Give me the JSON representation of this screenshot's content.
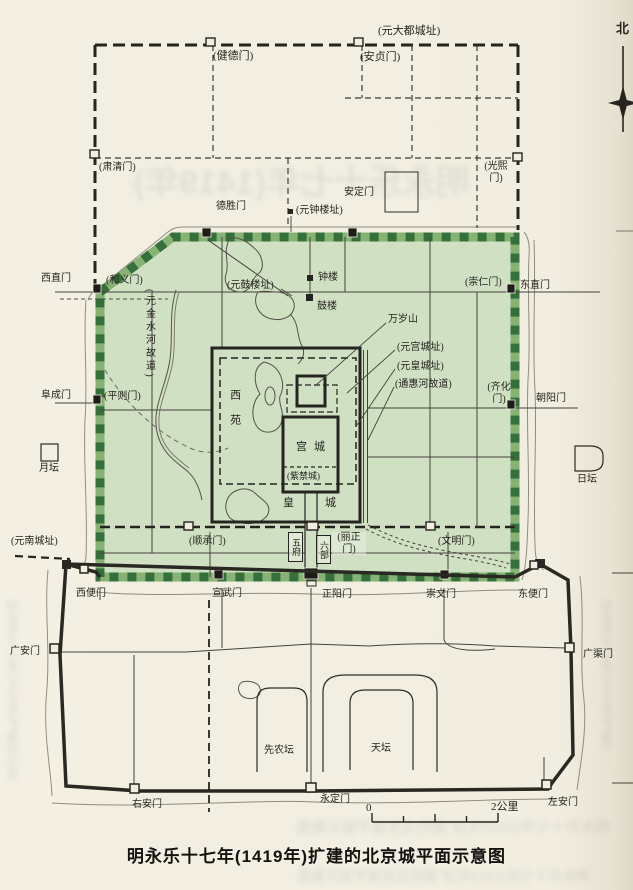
{
  "title": "明永乐十七年(1419年)扩建的北京城平面示意图",
  "compass": {
    "north": "北"
  },
  "scale_bar": {
    "zero": "0",
    "two_km": "2公里"
  },
  "yuan_dadu": {
    "site_label": "(元大都城址)",
    "south_city_site": "(元南城址)",
    "gates": {
      "jiande": "(健德门)",
      "anzhen": "(安贞门)",
      "suqing": "(肃清门)",
      "guangxi": "(光熙\n门)",
      "heyi": "(和义门)",
      "pingze": "(平则门)",
      "chongren": "(崇仁门)",
      "qihua": "(齐化\n门)",
      "shuncheng": "(顺承门)",
      "lizheng": "(丽正\n门)",
      "wenming": "(文明门)"
    },
    "relics": {
      "bell_tower_site": "(元钟楼址)",
      "drum_tower_site": "(元鼓楼址)",
      "palace_site": "(元宫城址)",
      "imperial_city_site": "(元皇城址)",
      "jinshui_river": "(元金水河故道)",
      "tonghui_river": "(通惠河故道)"
    }
  },
  "inner_city": {
    "gates": {
      "deshengmen": "德胜门",
      "andingmen": "安定门",
      "xizhimen": "西直门",
      "fuchengmen": "阜成门",
      "dongzhimen": "东直门",
      "chaoyangmen": "朝阳门",
      "xuanwumen": "宣武门",
      "zhengyangmen": "正阳门",
      "chongwenmen": "崇文门"
    },
    "landmarks": {
      "bell_tower": "钟楼",
      "drum_tower": "鼓楼",
      "wansuishan": "万岁山",
      "xiyuan": "西苑",
      "gongcheng": "宫城",
      "zijincheng": "(紫禁城)",
      "huangcheng": "皇城",
      "wufu": "五府",
      "liubu": "六部"
    }
  },
  "outer_city": {
    "gates": {
      "xibianmen": "西便门",
      "dongbianmen": "东便门",
      "guanganmen": "广安门",
      "guangqumen": "广渠门",
      "youanmen": "右安门",
      "yongdingmen": "永定门",
      "zuoanmen": "左安门"
    },
    "landmarks": {
      "xiannongtan": "先农坛",
      "tiantan": "天坛"
    }
  },
  "altars": {
    "yuetan": "月坛",
    "ritan": "日坛"
  },
  "colors": {
    "paper": "#f1ede0",
    "ming_city_fill": "#cfe0c3",
    "wall_dark_green": "#35703a",
    "wall_light_green": "#86b273",
    "ink": "#26241f"
  }
}
